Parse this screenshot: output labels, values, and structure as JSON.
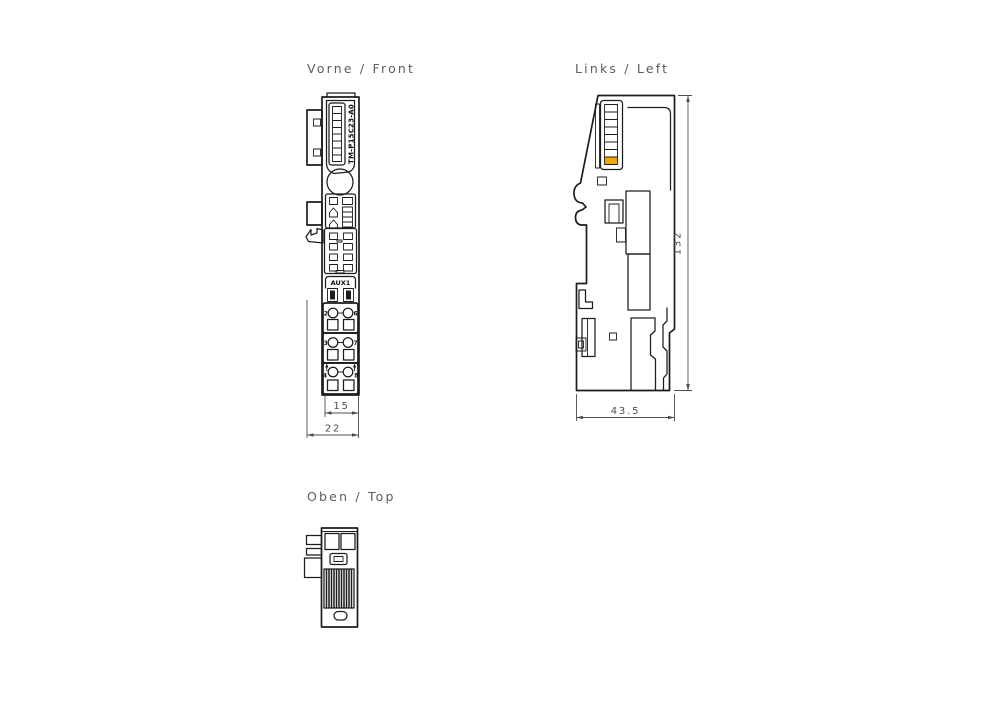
{
  "document": {
    "type": "technical-drawing-three-views",
    "background": "#ffffff"
  },
  "colors": {
    "line": "#1c1c1c",
    "dimension_text": "#4e4e4e",
    "title_text": "#5d5d5d",
    "accent": "#f5a800"
  },
  "titles": {
    "front": "Vorne / Front",
    "left": "Links / Left",
    "top": "Oben / Top"
  },
  "front_view": {
    "module_label": "TM-P15C23-A0",
    "aux_label": "AUX1",
    "terminals": {
      "r1l": "2",
      "r1r": "6",
      "r2l": "3",
      "r2r": "7",
      "r3l": "4",
      "r3r": "8"
    },
    "dims": {
      "terminal_width": "15",
      "total_width": "22"
    }
  },
  "left_view": {
    "dims": {
      "height": "132",
      "depth": "43.5"
    }
  },
  "top_view": {
    "features": [
      "plug-sockets",
      "side-tabs",
      "vent-grille",
      "release-slot"
    ]
  }
}
